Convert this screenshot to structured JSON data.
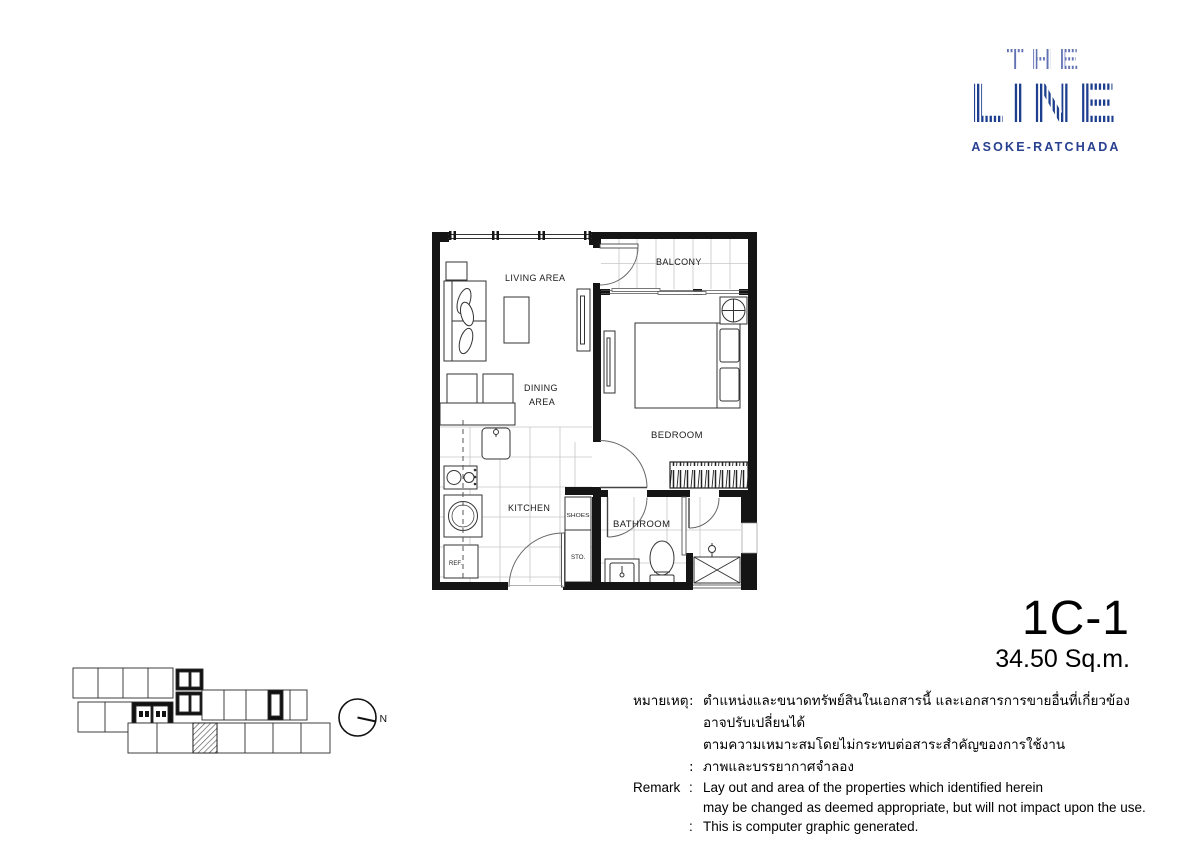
{
  "logo": {
    "the": "THE",
    "line": "LINE",
    "subtitle": "ASOKE-RATCHADA",
    "color_the": "#6372b4",
    "color_line": "#1d3e8e",
    "color_subtitle": "#27408f"
  },
  "unit": {
    "code": "1C-1",
    "area": "34.50 Sq.m."
  },
  "plan": {
    "labels": {
      "living": "LIVING AREA",
      "balcony": "BALCONY",
      "dining1": "DINING",
      "dining2": "AREA",
      "bedroom": "BEDROOM",
      "kitchen": "KITCHEN",
      "bathroom": "BATHROOM",
      "shoes": "SHOES",
      "sto": "STO.",
      "ref": "REF."
    }
  },
  "key_plan": {
    "north": "N"
  },
  "notes": {
    "rows": [
      {
        "label": "หมายเหตุ",
        "colon": ":",
        "text": "ตำแหน่งและขนาดทรัพย์สินในเอกสารนี้ และเอกสารการขายอื่นที่เกี่ยวข้อง อาจปรับเปลี่ยนได้"
      },
      {
        "label": "",
        "colon": "",
        "text": "ตามความเหมาะสมโดยไม่กระทบต่อสาระสำคัญของการใช้งาน"
      },
      {
        "label": "",
        "colon": ":",
        "text": "ภาพและบรรยากาศจำลอง"
      },
      {
        "label": "Remark",
        "colon": ":",
        "text": "Lay out and area of the properties which identified herein"
      },
      {
        "label": "",
        "colon": "",
        "text": "may be changed as deemed appropriate, but will not impact upon the use."
      },
      {
        "label": "",
        "colon": ":",
        "text": "This is computer graphic generated."
      }
    ]
  }
}
